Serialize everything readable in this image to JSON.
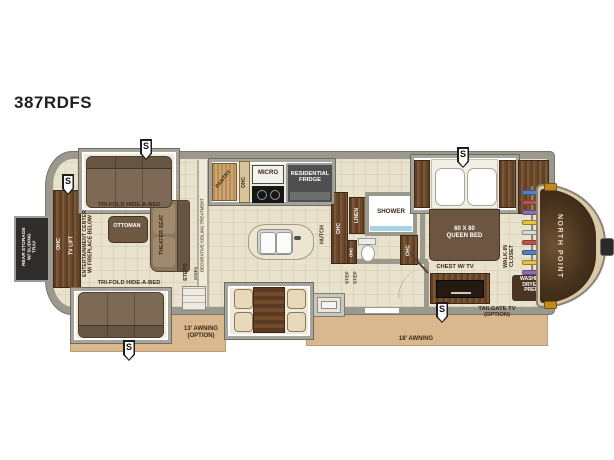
{
  "title": "387RDFS",
  "badge": {
    "label": "S"
  },
  "rear": {
    "storage": "REAR STORAGE\nW/ SLIDING\nTRAY"
  },
  "living": {
    "ohc": "OHC",
    "tv_lift": "TV LIFT",
    "entertainment": "ENTERTAINMENT CENTER\nW/ FIREPLACE BELOW",
    "trifold_top": "TRI-FOLD HIDE-A-BED",
    "trifold_bottom": "TRI-FOLD HIDE-A-BED",
    "ottoman": "OTTOMAN",
    "theater_seat": "THEATER SEAT",
    "steps": "STEPS",
    "steps_small": "STEPS",
    "ceiling": "DECORATIVE CEILING TREATMENT"
  },
  "kitchen": {
    "pantry": "PANTRY",
    "ohc": "OHC",
    "micro": "MICRO",
    "fridge": "RESIDENTIAL\nFRIDGE",
    "hutch": "HUTCH",
    "ohc_tall": "OHC"
  },
  "bath": {
    "linen": "LINEN",
    "shower": "SHOWER",
    "ohc_small": "OHC",
    "ohc_right": "OHC",
    "step_1": "STEP",
    "step_2": "STEP"
  },
  "bedroom": {
    "bed": "60 X 80\nQUEEN BED",
    "chest": "CHEST W/ TV",
    "closet": "WALK-IN\nCLOSET",
    "washer": "WASHER\nDRYER\nPREP"
  },
  "front": {
    "brand": "NORTH POINT",
    "tailgate_tv": "TAILGATE TV\n(OPTION)"
  },
  "exterior": {
    "awning_left": "13' AWNING\n(OPTION)",
    "awning_right": "18' AWNING"
  },
  "colors": {
    "awning": "#d9b88f",
    "wall": "#9b988e",
    "floor": "#e9e2cc",
    "wood": "#6b4a2c",
    "sofa": "#7c6a56",
    "bed_blanket": "#6d5641",
    "front_cap": "#4a3421",
    "shower_accent": "#a5d4e4",
    "closet_clothes": [
      "#4f7fd0",
      "#c0504d",
      "#8e6bbf",
      "#e3c23f",
      "#d9d9d9"
    ]
  }
}
